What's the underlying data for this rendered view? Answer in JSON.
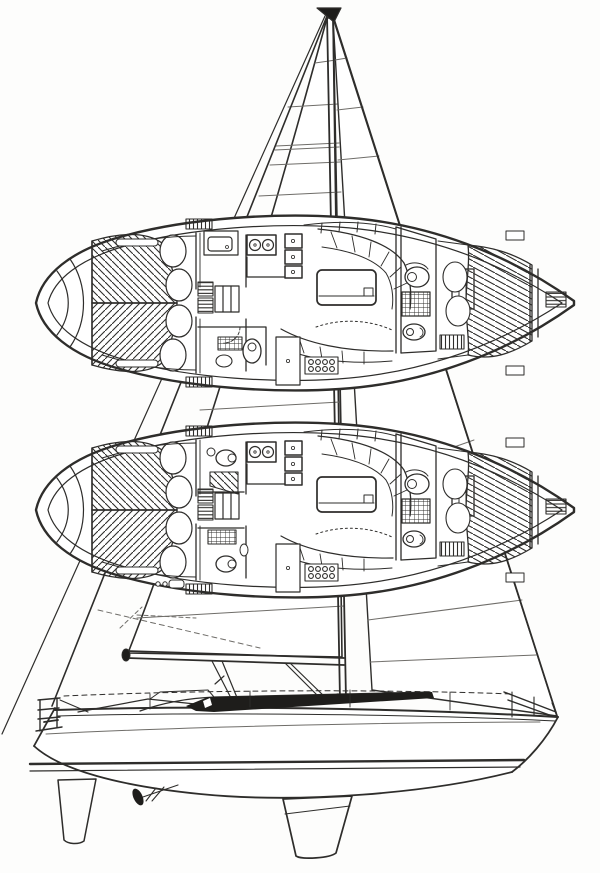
{
  "canvas": {
    "width": "600",
    "height": "873",
    "viewBox": "0 0 600 873"
  },
  "palette": {
    "ink": "#2e2d2b",
    "ink_soft": "#6f6d69",
    "paper": "#ffffff",
    "dark_fill": "#1e1d1b"
  },
  "parts": {
    "figure": "sailboat technical drawing: sail profile with two interior plan views",
    "rig": "mast, boom, mainsail, headsail, forestay, twin backstays",
    "upper_plan": "interior accommodation plan, forward vanity + single head layout",
    "lower_plan": "interior accommodation plan, twin forward heads layout",
    "v_berth": "forward double berth, chevron-hatched",
    "galley": "stove with two burners, triple sink column, counters",
    "dinette": "curved settee, rectangular saloon table, lower bench",
    "aft_head": "toilet, gridded shower sole, wash basin",
    "aft_cabin": "diagonally hatched double berth with pillows",
    "profile_hull": "hull side view with window band, boot stripe, reverse transom",
    "appendages": "fin keel, spade rudder, propeller and shaft",
    "rails": "bow pulpit and stern pushpit"
  }
}
